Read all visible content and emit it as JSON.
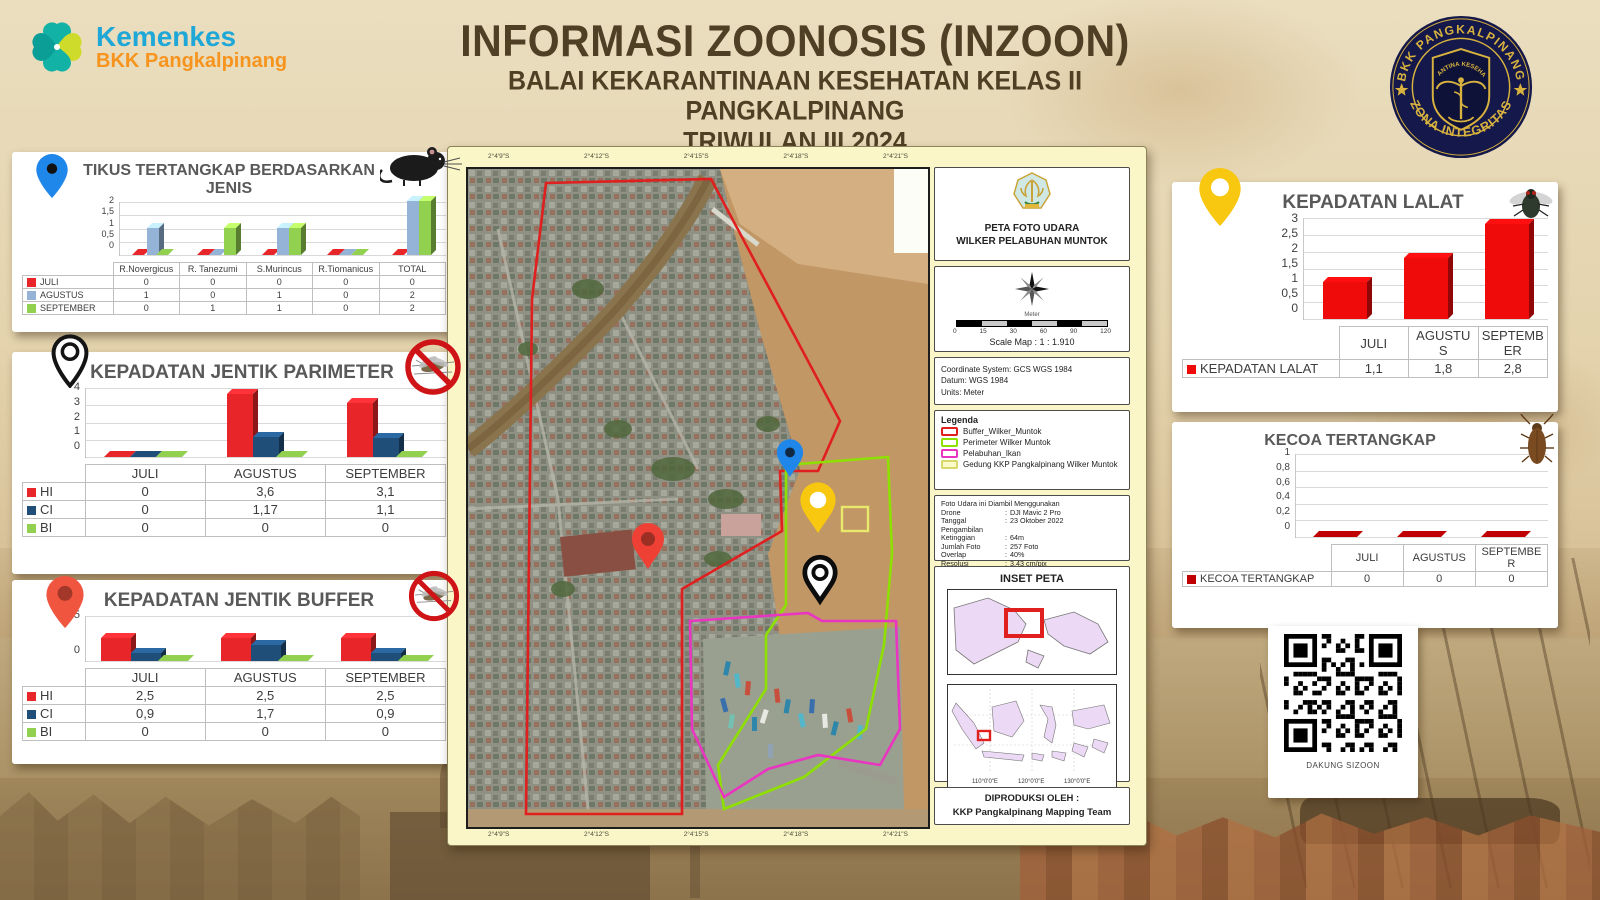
{
  "header": {
    "brand": "Kemenkes",
    "brand_sub": "BKK Pangkalpinang",
    "title1": "INFORMASI ZOONOSIS (INZOON)",
    "title2": "BALAI KEKARANTINAAN KESEHATAN KELAS II PANGKALPINANG",
    "title3": "TRIWULAN III 2024",
    "badge_top": "BKK PANGKALPINANG",
    "badge_bottom": "ZONA INTEGRITAS",
    "badge_inner": "KARANTINA KESEHATAN"
  },
  "chart_data": [
    {
      "type": "bar",
      "title": "TIKUS TERTANGKAP BERDASARKAN JENIS",
      "categories": [
        "R.Novergicus",
        "R. Tanezumi",
        "S.Murincus",
        "R.Tiomanicus",
        "TOTAL"
      ],
      "series": [
        {
          "name": "JULI",
          "color": "#e8262a",
          "values": [
            0,
            0,
            0,
            0,
            0
          ],
          "display": [
            "0",
            "0",
            "0",
            "0",
            "0"
          ]
        },
        {
          "name": "AGUSTUS",
          "color": "#95b3d7",
          "values": [
            1,
            0,
            1,
            0,
            2
          ],
          "display": [
            "1",
            "0",
            "1",
            "0",
            "2"
          ]
        },
        {
          "name": "SEPTEMBER",
          "color": "#92d050",
          "values": [
            0,
            1,
            1,
            0,
            2
          ],
          "display": [
            "0",
            "1",
            "1",
            "0",
            "2"
          ]
        }
      ],
      "ylim": [
        0,
        2
      ],
      "yticks": [
        "2",
        "1,5",
        "1",
        "0,5",
        "0"
      ],
      "grid": true,
      "legend_position": "table-left"
    },
    {
      "type": "bar",
      "title": "KEPADATAN JENTIK PARIMETER",
      "categories": [
        "JULI",
        "AGUSTUS",
        "SEPTEMBER"
      ],
      "series": [
        {
          "name": "HI",
          "color": "#e8262a",
          "values": [
            0,
            3.6,
            3.1
          ],
          "display": [
            "0",
            "3,6",
            "3,1"
          ]
        },
        {
          "name": "CI",
          "color": "#1f4e79",
          "values": [
            0,
            1.17,
            1.1
          ],
          "display": [
            "0",
            "1,17",
            "1,1"
          ]
        },
        {
          "name": "BI",
          "color": "#92d050",
          "values": [
            0,
            0,
            0
          ],
          "display": [
            "0",
            "0",
            "0"
          ]
        }
      ],
      "ylim": [
        0,
        4
      ],
      "yticks": [
        "4",
        "3",
        "2",
        "1",
        "0"
      ],
      "grid": true,
      "legend_position": "table-left"
    },
    {
      "type": "bar",
      "title": "KEPADATAN JENTIK BUFFER",
      "categories": [
        "JULI",
        "AGUSTUS",
        "SEPTEMBER"
      ],
      "series": [
        {
          "name": "HI",
          "color": "#e8262a",
          "values": [
            2.5,
            2.5,
            2.5
          ],
          "display": [
            "2,5",
            "2,5",
            "2,5"
          ]
        },
        {
          "name": "CI",
          "color": "#1f4e79",
          "values": [
            0.9,
            1.7,
            0.9
          ],
          "display": [
            "0,9",
            "1,7",
            "0,9"
          ]
        },
        {
          "name": "BI",
          "color": "#92d050",
          "values": [
            0,
            0,
            0
          ],
          "display": [
            "0",
            "0",
            "0"
          ]
        }
      ],
      "ylim": [
        0,
        5
      ],
      "yticks": [
        "5",
        "0"
      ],
      "grid": true,
      "legend_position": "table-left"
    },
    {
      "type": "bar",
      "title": "KEPADATAN LALAT",
      "categories": [
        "JULI",
        "AGUSTUS",
        "SEPTEMBER"
      ],
      "series": [
        {
          "name": "KEPADATAN LALAT",
          "color": "#f00b0b",
          "values": [
            1.1,
            1.8,
            2.8
          ],
          "display": [
            "1,1",
            "1,8",
            "2,8"
          ]
        }
      ],
      "ylim": [
        0,
        3
      ],
      "yticks": [
        "3",
        "2,5",
        "2",
        "1,5",
        "1",
        "0,5",
        "0"
      ],
      "grid": true,
      "legend_position": "table-left"
    },
    {
      "type": "bar",
      "title": "KECOA TERTANGKAP",
      "categories": [
        "JULI",
        "AGUSTUS",
        "SEPTEMBER"
      ],
      "series": [
        {
          "name": "KECOA TERTANGKAP",
          "color": "#c00000",
          "values": [
            0,
            0,
            0
          ],
          "display": [
            "0",
            "0",
            "0"
          ]
        }
      ],
      "ylim": [
        0,
        1
      ],
      "yticks": [
        "1",
        "0,8",
        "0,6",
        "0,4",
        "0,2",
        "0"
      ],
      "grid": true,
      "legend_position": "table-left"
    }
  ],
  "map_panel": {
    "ticks": [
      "2°4'9\"S",
      "2°4'12\"S",
      "2°4'15\"S",
      "2°4'18\"S",
      "2°4'21\"S"
    ],
    "header": {
      "title1": "PETA FOTO UDARA",
      "title2": "WILKER PELABUHAN MUNTOK"
    },
    "scale": {
      "numbers": [
        "0",
        "15",
        "30",
        "60",
        "90",
        "120"
      ],
      "unit": "Meter",
      "label": "Scale Map : 1 : 1.910"
    },
    "coords": [
      "Coordinate System: GCS WGS 1984",
      "Datum: WGS 1984",
      "Units: Meter"
    ],
    "legend": {
      "title": "Legenda",
      "items": [
        {
          "label": "Buffer_Wilker_Muntok",
          "color": "#e01f1f",
          "fill": "#ffffff"
        },
        {
          "label": "Perimeter Wilker Muntok",
          "color": "#8ee000",
          "fill": "#ffffff"
        },
        {
          "label": "Pelabuhan_Ikan",
          "color": "#e935c1",
          "fill": "#ffffff"
        },
        {
          "label": "Gedung KKP Pangkalpinang Wilker Muntok",
          "color": "#d8d86a",
          "fill": "#fbfbc9"
        }
      ]
    },
    "drone": {
      "intro": "Foto Udara ini Diambil Menggunakan",
      "rows": [
        [
          "Drone",
          "DJI Mavic 2 Pro"
        ],
        [
          "Tanggal Pengambilan",
          "23 Oktober 2022"
        ],
        [
          "Ketinggian",
          "64m"
        ],
        [
          "Jumlah Foto",
          "257 Foto"
        ],
        [
          "Overlap",
          "40%"
        ],
        [
          "Resolusi",
          "3,43 cm/pix"
        ]
      ]
    },
    "inset": {
      "title": "INSET PETA",
      "lon_labels": [
        "110°0'0\"E",
        "120°0'0\"E",
        "130°0'0\"E"
      ]
    },
    "produced": {
      "line1": "DIPRODUKSI OLEH :",
      "line2": "KKP Pangkalpinang Mapping Team"
    }
  },
  "qr": {
    "caption": "DAKUNG SIZOON"
  },
  "colors": {
    "accent_red": "#e8262a",
    "accent_blue_light": "#95b3d7",
    "accent_navy": "#1f4e79",
    "accent_green": "#92d050",
    "title_brown": "#4f3f24",
    "brand_cyan": "#1fa7d7",
    "brand_orange": "#f7941e",
    "badge_navy": "#14184a",
    "badge_gold": "#d8b23f",
    "map_card_yellow": "#fbf6c8"
  }
}
